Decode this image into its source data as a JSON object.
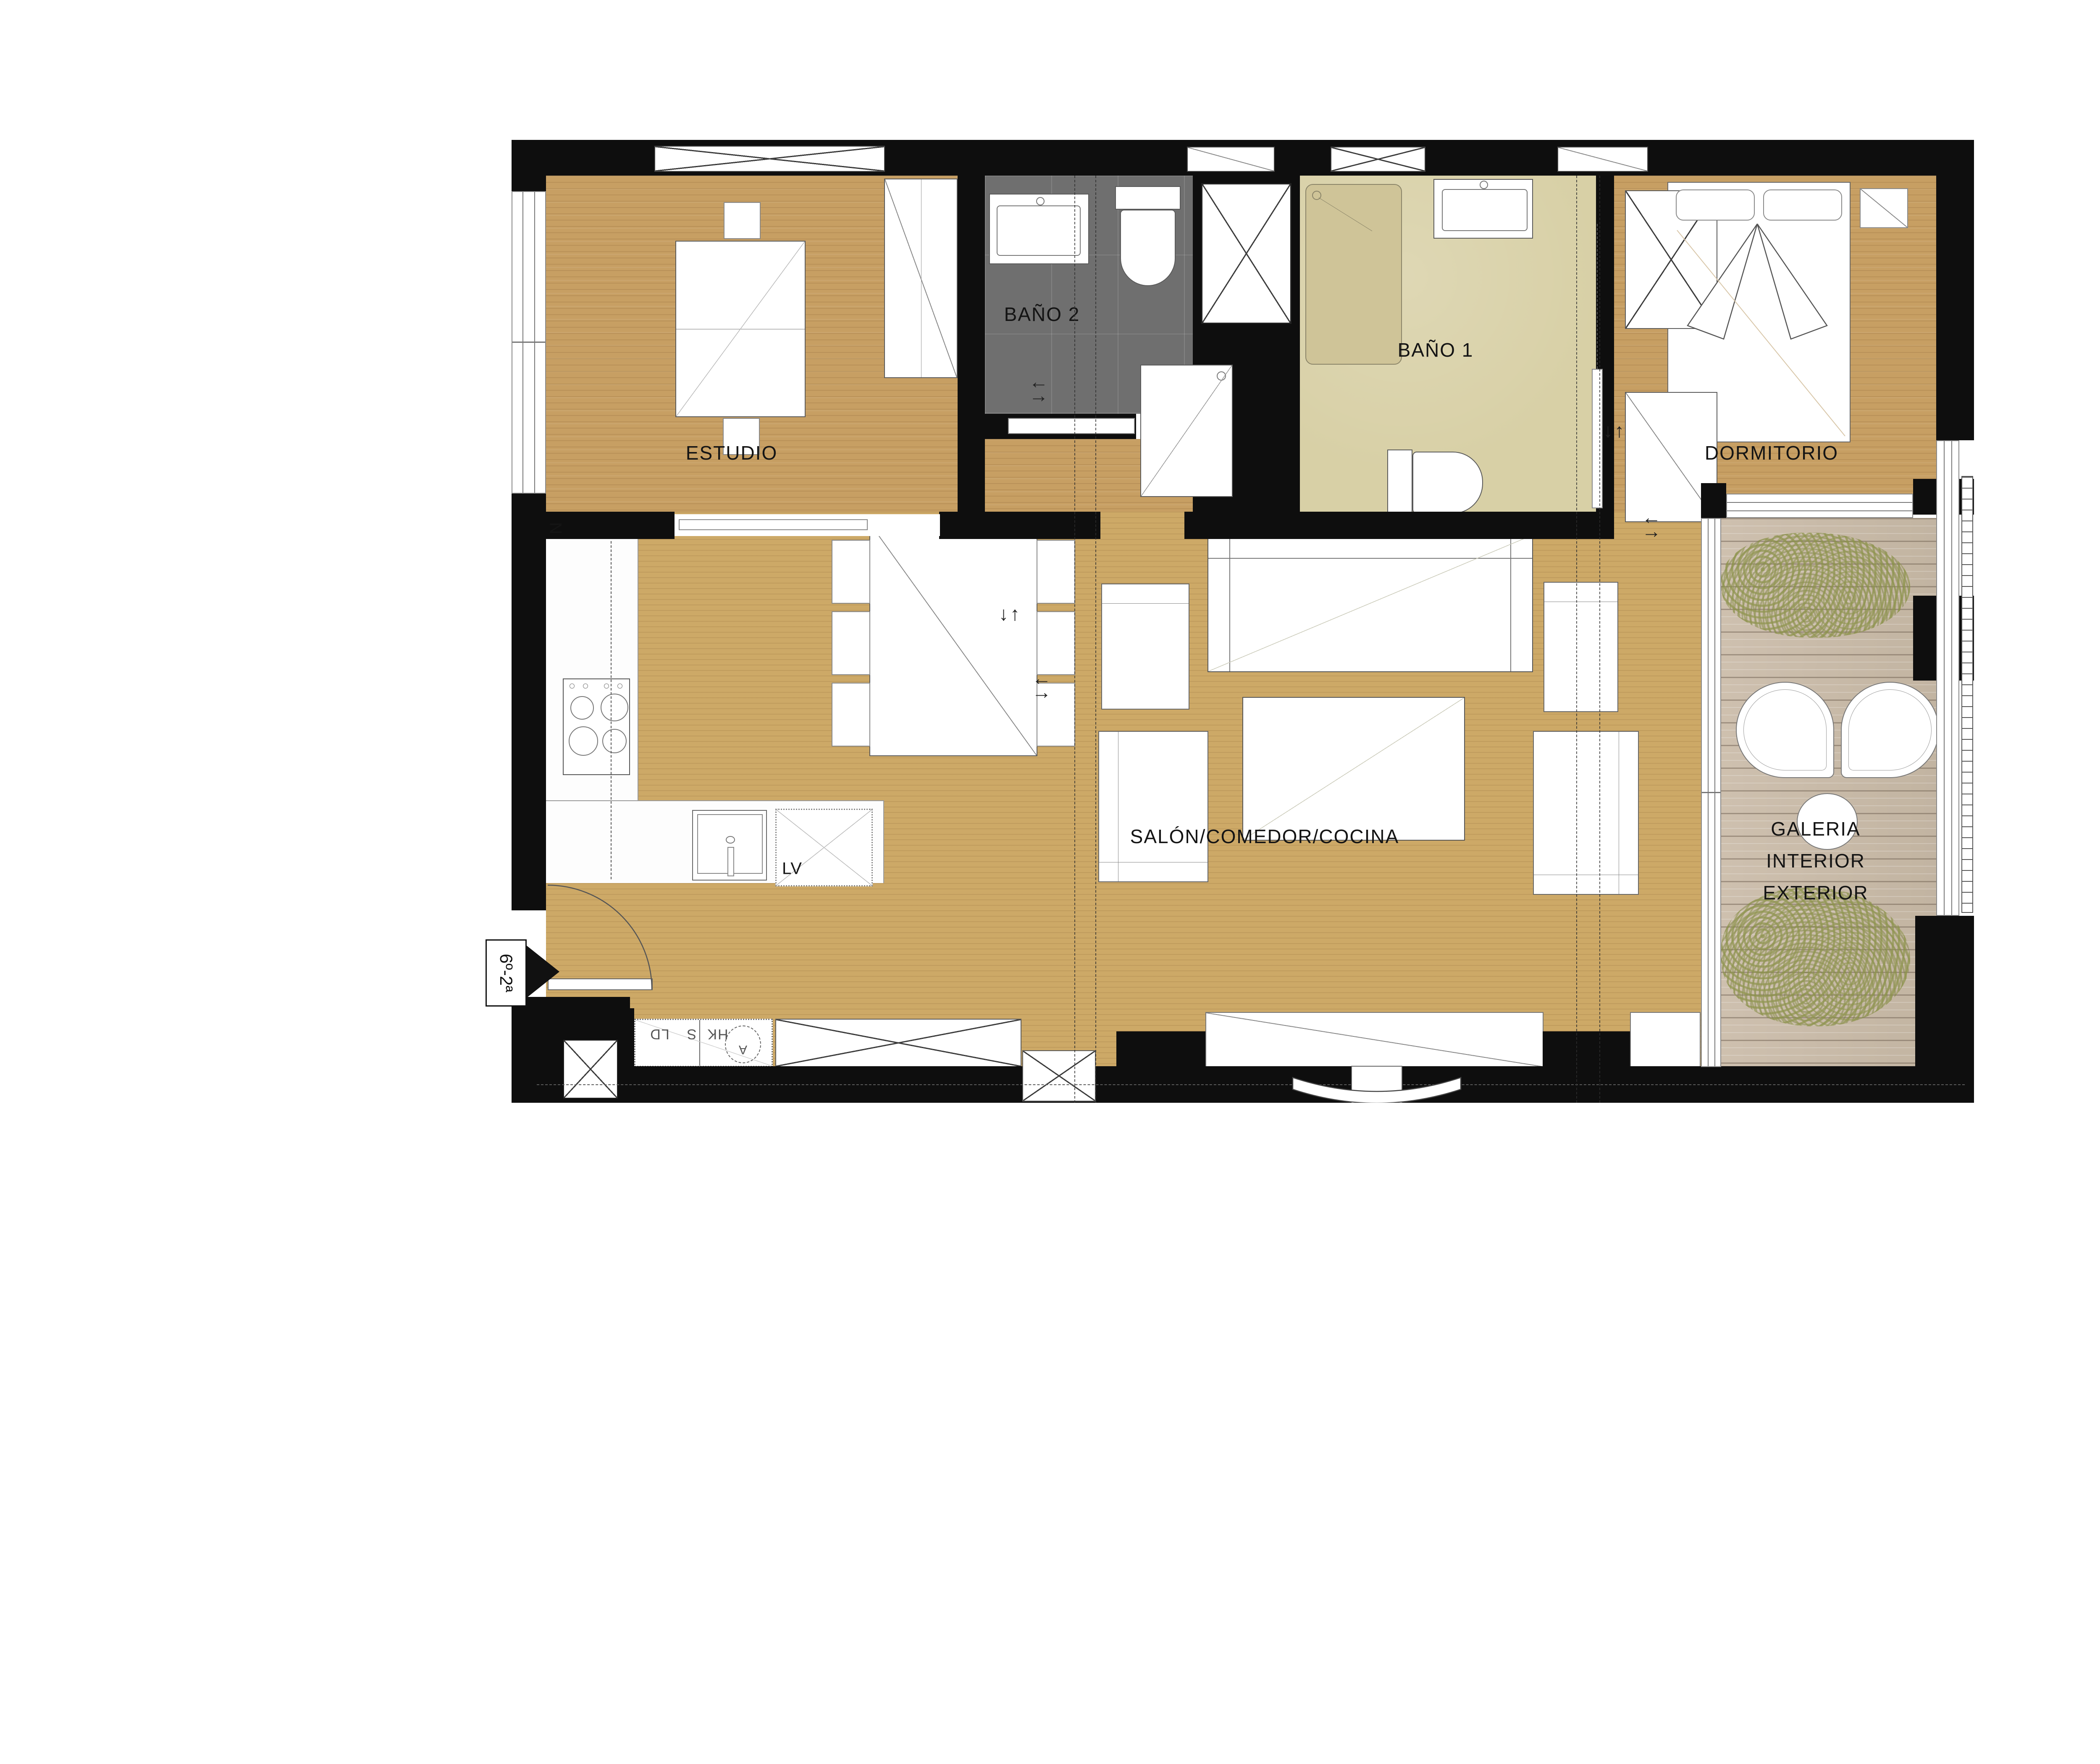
{
  "plan": {
    "rooms": {
      "estudio": "ESTUDIO",
      "bano2": "BAÑO 2",
      "bano1": "BAÑO 1",
      "dormitorio": "DORMITORIO",
      "salon": "SALÓN/COMEDOR/COCINA",
      "galeria": [
        "GALERIA",
        "INTERIOR",
        "EXTERIOR"
      ]
    },
    "appliances": {
      "dishwasher": "LV",
      "washer": "LD",
      "dryer": "S",
      "hk": "HK",
      "vent_circle": "A",
      "kitchen_note": "N"
    },
    "entrance": {
      "unit_sign": "6º-2ª"
    },
    "colors": {
      "wall": "#0e0e0e",
      "wood_floor": "#c79f63",
      "deck_floor": "#c9bcab",
      "bath2_tiles": "#6f6f6f",
      "bath1_floor": "#d8d0a6",
      "plants": "#8b9248",
      "furniture_outline": "#555555"
    }
  }
}
